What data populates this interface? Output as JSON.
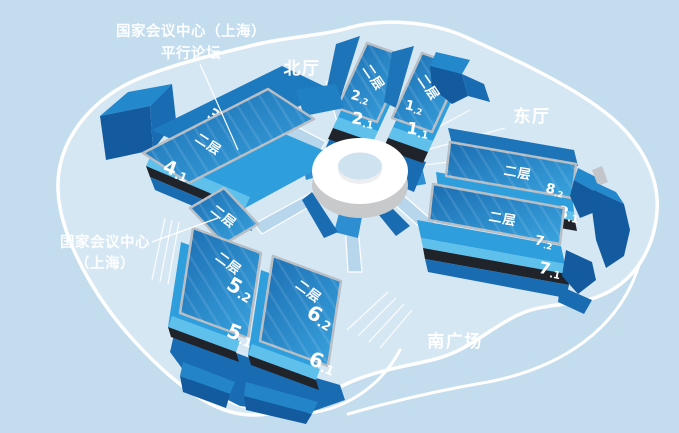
{
  "colors": {
    "background": "#c3dcee",
    "site_fill": "#d6e7f4",
    "outline_white": "#ffffff",
    "building_primary": "#1b72b8",
    "building_dark": "#135b9e",
    "building_cap_top": "#2488cc",
    "roof_bright": "#2f9edd",
    "roof_cyan_band": "#5fc0ec",
    "slab_border_silver": "#b8bec4",
    "edge_dark": "#20242a",
    "road_light": "#b7d6ec",
    "ring_side_gray": "#c7c9cb"
  },
  "labels": {
    "forum_annotation": {
      "line1": "国家会议中心（上海）",
      "line2": "平行论坛"
    },
    "necc_annotation": {
      "line1": "国家会议中心",
      "line2": "（上海）"
    },
    "areas": {
      "north_hall": "北厅",
      "east_hall": "东厅",
      "south_plaza": "南广场"
    },
    "second_floor": "二层",
    "halls": {
      "h3": "3",
      "h4_1": "4.1",
      "h2_2": "2.2",
      "h2_1": "2.1",
      "h1_2": "1.2",
      "h1_1": "1.1",
      "h8_2": "8.2",
      "h8_1": "8.1",
      "h7_2": "7.2",
      "h7_1": "7.1",
      "h5_2": "5.2",
      "h5_1": "5.1",
      "h6_2": "6.2",
      "h6_1": "6.1"
    }
  }
}
